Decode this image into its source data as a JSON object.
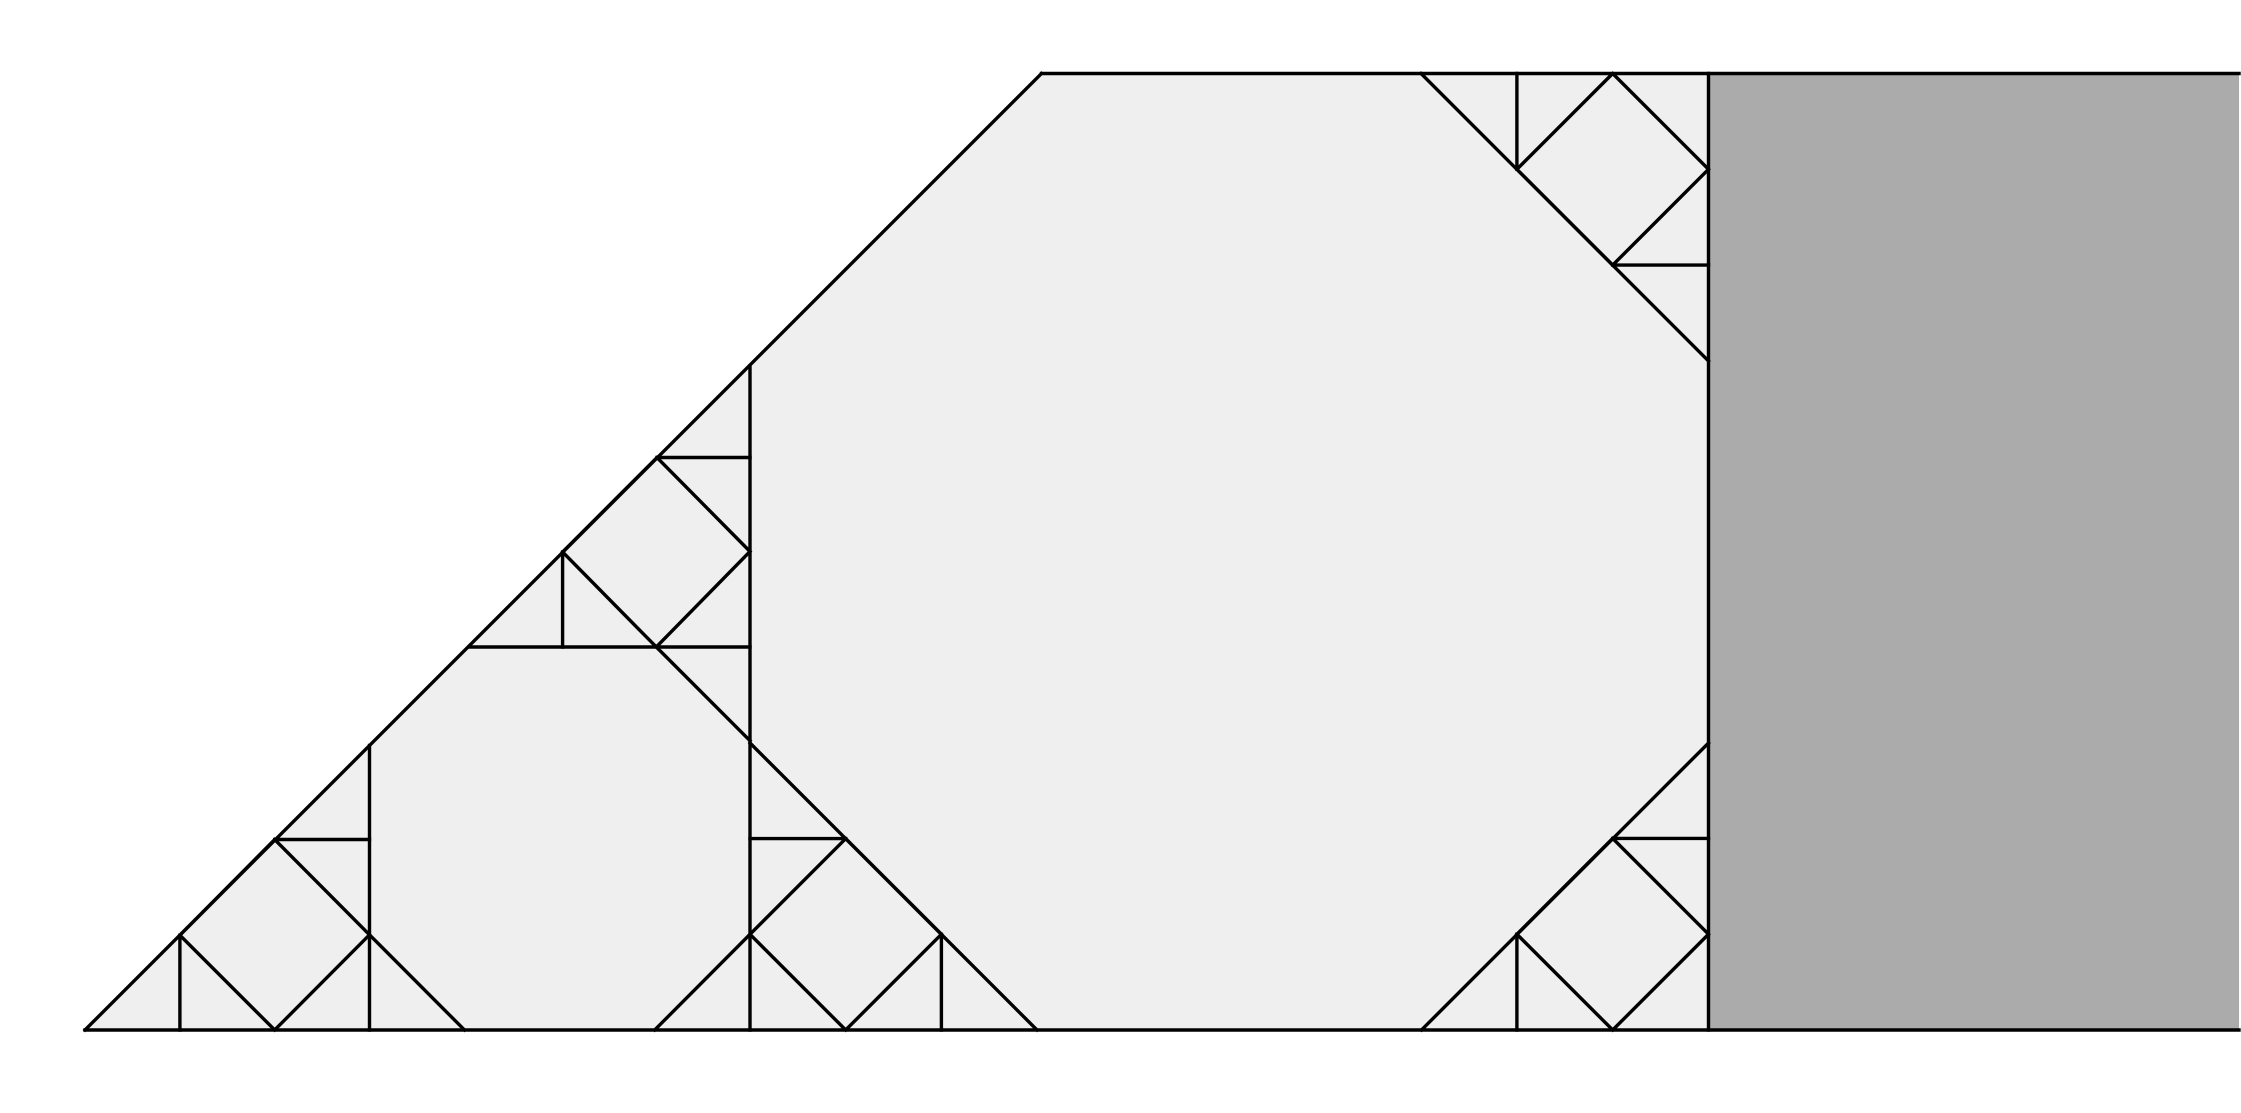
{
  "canvas": {
    "width": 2241,
    "height": 1113,
    "background_color": "#ffffff"
  },
  "style": {
    "line_color": "#000000",
    "line_width": 3.4,
    "trapezoid_fill": "#efefef",
    "gray_block_fill": "#ababab"
  },
  "regions": [
    {
      "name": "main-trapezoid-region",
      "fill_key": "trapezoid_fill",
      "points": [
        [
          85,
          1030
        ],
        [
          1041.5,
          73.5
        ],
        [
          1708.5,
          73.5
        ],
        [
          1708.5,
          1030
        ]
      ]
    },
    {
      "name": "gray-block",
      "fill_key": "gray_block_fill",
      "points": [
        [
          1708.5,
          73.5
        ],
        [
          2239,
          73.5
        ],
        [
          2239,
          1030
        ],
        [
          1708.5,
          1030
        ]
      ]
    }
  ],
  "segments": [
    {
      "name": "hypotenuse-edge",
      "x1": 85,
      "y1": 1030,
      "x2": 1041.5,
      "y2": 73.5
    },
    {
      "name": "top-edge",
      "x1": 1041.5,
      "y1": 73.5,
      "x2": 2239,
      "y2": 73.5
    },
    {
      "name": "bottom-edge",
      "x1": 85,
      "y1": 1030,
      "x2": 2239,
      "y2": 1030
    },
    {
      "name": "gray-block-left-edge",
      "x1": 1708.5,
      "y1": 73.5,
      "x2": 1708.5,
      "y2": 1030
    },
    {
      "name": "vertical-divider-left",
      "x1": 369.5,
      "y1": 745.5,
      "x2": 369.5,
      "y2": 1030
    },
    {
      "name": "vertical-divider-middle",
      "x1": 750,
      "y1": 366,
      "x2": 750,
      "y2": 1030
    },
    {
      "name": "horizontal-divider",
      "x1": 469,
      "y1": 647,
      "x2": 750,
      "y2": 647
    },
    {
      "name": "octagon-small-cut-top-right",
      "x1": 656.3,
      "y1": 647,
      "x2": 750,
      "y2": 740.7
    },
    {
      "name": "octagon-small-cut-bottom-right",
      "x1": 750,
      "y1": 934.3,
      "x2": 654.7,
      "y2": 1030
    },
    {
      "name": "octagon-small-cut-bottom-left",
      "x1": 369.5,
      "y1": 934.8,
      "x2": 464.5,
      "y2": 1030
    },
    {
      "name": "octagon-large-cut-top-right",
      "x1": 1421,
      "y1": 73.5,
      "x2": 1708.5,
      "y2": 361
    },
    {
      "name": "octagon-large-cut-bottom-left",
      "x1": 750,
      "y1": 743,
      "x2": 1037,
      "y2": 1030
    },
    {
      "name": "octagon-large-cut-bottom-right",
      "x1": 1708.5,
      "y1": 743,
      "x2": 1421.5,
      "y2": 1030
    },
    {
      "name": "connector-lower-left-horizontal",
      "x1": 274.7,
      "y1": 839.5,
      "x2": 369.5,
      "y2": 839.5
    },
    {
      "name": "connector-lower-left-vertical",
      "x1": 179.9,
      "y1": 935.2,
      "x2": 179.9,
      "y2": 1030
    },
    {
      "name": "connector-middle-horizontal",
      "x1": 657,
      "y1": 457.5,
      "x2": 750,
      "y2": 457.5
    },
    {
      "name": "connector-middle-vertical",
      "x1": 562.6,
      "y1": 552,
      "x2": 562.6,
      "y2": 647
    },
    {
      "name": "connector-top-right-vertical",
      "x1": 1516.9,
      "y1": 73.5,
      "x2": 1516.9,
      "y2": 169.3
    },
    {
      "name": "connector-top-right-horizontal",
      "x1": 1612.7,
      "y1": 265.1,
      "x2": 1708.5,
      "y2": 265.1
    },
    {
      "name": "connector-bottom-middle-horizontal",
      "x1": 750,
      "y1": 838.6,
      "x2": 845.7,
      "y2": 838.6
    },
    {
      "name": "connector-bottom-middle-vertical",
      "x1": 941.4,
      "y1": 934.3,
      "x2": 941.4,
      "y2": 1030
    },
    {
      "name": "connector-bottom-right-horizontal",
      "x1": 1612.7,
      "y1": 838.4,
      "x2": 1708.5,
      "y2": 838.4
    },
    {
      "name": "connector-bottom-right-vertical",
      "x1": 1516.9,
      "y1": 934.2,
      "x2": 1516.9,
      "y2": 1030
    }
  ],
  "inscribed_squares": [
    {
      "name": "inscribed-square-lower-left",
      "points": [
        [
          369.5,
          934.8
        ],
        [
          274.7,
          839.5
        ],
        [
          179.9,
          935.2
        ],
        [
          274.7,
          1030
        ]
      ]
    },
    {
      "name": "inscribed-square-middle",
      "points": [
        [
          750,
          551.5
        ],
        [
          657,
          457.5
        ],
        [
          562.6,
          552
        ],
        [
          656.3,
          647
        ]
      ]
    },
    {
      "name": "inscribed-square-top-right",
      "points": [
        [
          1612.7,
          73.5
        ],
        [
          1516.9,
          169.3
        ],
        [
          1612.7,
          265.1
        ],
        [
          1708.5,
          169.3
        ]
      ]
    },
    {
      "name": "inscribed-square-bottom-middle",
      "points": [
        [
          750,
          934.3
        ],
        [
          845.7,
          838.6
        ],
        [
          941.4,
          934.3
        ],
        [
          845.7,
          1030
        ]
      ]
    },
    {
      "name": "inscribed-square-bottom-right",
      "points": [
        [
          1708.5,
          934.2
        ],
        [
          1612.7,
          838.4
        ],
        [
          1516.9,
          934.2
        ],
        [
          1612.7,
          1030
        ]
      ]
    }
  ]
}
